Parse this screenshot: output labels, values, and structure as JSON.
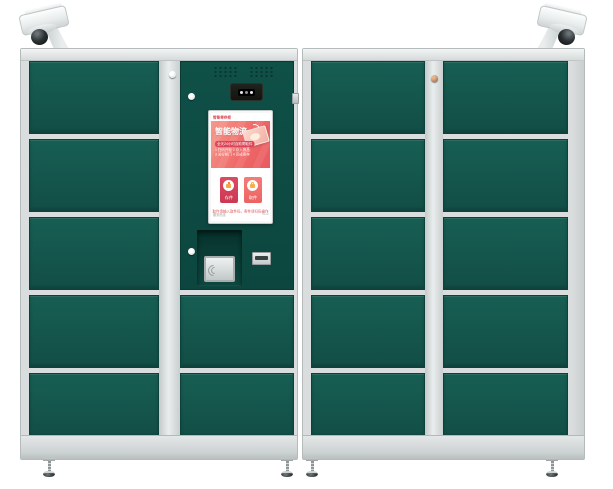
{
  "meta": {
    "description": "Smart parcel locker: two green cabinets with dual surveillance dome cameras, central touchscreen console, QR scanner, NFC pad, card slot and adjustable feet"
  },
  "colors": {
    "door_green": "#14574d",
    "console_green": "#0e4c44",
    "frame_silver": "#d9dddd",
    "screen_gradient_start": "#f59a8e",
    "screen_gradient_end": "#e85a60",
    "button_primary": "#d24058",
    "button_secondary": "#ee6565",
    "glyph_orange": "#f5a64b",
    "brand_red": "#d8414e"
  },
  "cabinet": {
    "left": {
      "door_rows": 5,
      "door_columns": 2,
      "console_doors": 2
    },
    "right": {
      "door_rows": 5,
      "door_columns": 2
    }
  },
  "screen": {
    "header": {
      "brand": "智能寄存柜",
      "menu": "帮助 · 登录"
    },
    "hero": {
      "title": "智能物流",
      "banner": "全天24小时自助寄取件",
      "steps_line1": "1 扫码开柜  2 存入物品",
      "steps_line2": "3 关好柜门  4 完成寄存"
    },
    "buttons": [
      {
        "label": "存件"
      },
      {
        "label": "取件"
      }
    ],
    "notice": "取件请输入取件码，寄件请扫码操作",
    "footer": {
      "left": "服务热线",
      "right": "V1.0"
    }
  }
}
